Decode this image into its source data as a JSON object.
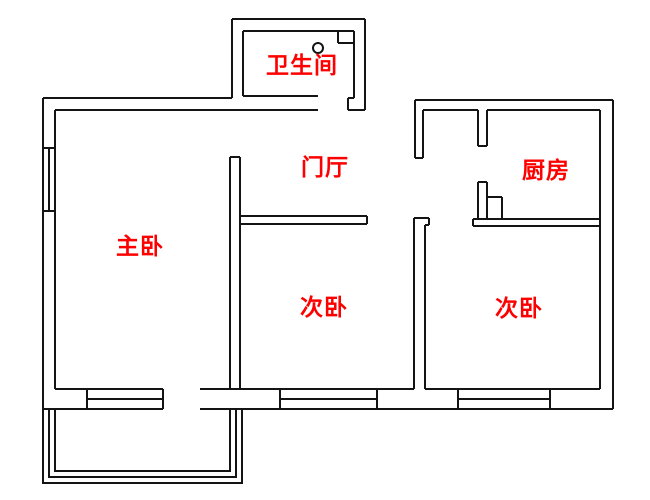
{
  "meta": {
    "type": "apartment-floor-plan",
    "background": "#ffffff"
  },
  "colors": {
    "wall": "#141414",
    "label": "#ff0000"
  },
  "canvas": {
    "width": 650,
    "height": 500
  },
  "rooms": [
    {
      "id": "bathroom",
      "label": "卫生间",
      "x": 302,
      "y": 63
    },
    {
      "id": "entrance-hall",
      "label": "门厅",
      "x": 325,
      "y": 165
    },
    {
      "id": "kitchen",
      "label": "厨房",
      "x": 546,
      "y": 168
    },
    {
      "id": "master-bedroom",
      "label": "主卧",
      "x": 140,
      "y": 244
    },
    {
      "id": "second-bedroom-middle",
      "label": "次卧",
      "x": 324,
      "y": 305
    },
    {
      "id": "second-bedroom-right",
      "label": "次卧",
      "x": 519,
      "y": 306
    }
  ],
  "plan": {
    "wall_segments": [
      [
        43,
        98,
        232,
        98
      ],
      [
        43,
        98,
        43,
        409
      ],
      [
        55,
        110,
        55,
        389
      ],
      [
        55,
        110,
        318,
        110
      ],
      [
        232,
        19,
        232,
        98
      ],
      [
        232,
        19,
        365,
        19
      ],
      [
        365,
        19,
        365,
        110
      ],
      [
        243,
        31,
        243,
        96
      ],
      [
        243,
        31,
        354,
        31
      ],
      [
        354,
        31,
        354,
        98
      ],
      [
        243,
        96,
        318,
        96
      ],
      [
        348,
        98,
        354,
        98
      ],
      [
        348,
        98,
        348,
        110
      ],
      [
        348,
        110,
        365,
        110
      ],
      [
        230,
        157,
        240,
        157
      ],
      [
        230,
        157,
        230,
        389
      ],
      [
        240,
        157,
        240,
        389
      ],
      [
        240,
        216,
        367,
        216
      ],
      [
        240,
        224,
        367,
        224
      ],
      [
        367,
        216,
        367,
        224
      ],
      [
        414,
        218,
        429,
        218
      ],
      [
        429,
        218,
        429,
        225
      ],
      [
        425,
        225,
        429,
        225
      ],
      [
        414,
        218,
        414,
        389
      ],
      [
        425,
        225,
        425,
        389
      ],
      [
        415,
        100,
        613,
        100
      ],
      [
        415,
        100,
        415,
        158
      ],
      [
        415,
        158,
        423,
        158
      ],
      [
        423,
        110,
        423,
        158
      ],
      [
        423,
        110,
        478,
        110
      ],
      [
        487,
        110,
        600,
        110
      ],
      [
        478,
        110,
        478,
        146
      ],
      [
        487,
        110,
        487,
        146
      ],
      [
        478,
        146,
        487,
        146
      ],
      [
        478,
        182,
        487,
        182
      ],
      [
        478,
        182,
        478,
        219
      ],
      [
        487,
        182,
        487,
        219
      ],
      [
        473,
        219,
        473,
        226
      ],
      [
        473,
        219,
        600,
        219
      ],
      [
        473,
        226,
        600,
        226
      ],
      [
        600,
        110,
        600,
        389
      ],
      [
        613,
        100,
        613,
        409
      ],
      [
        55,
        389,
        163,
        389
      ],
      [
        200,
        389,
        414,
        389
      ],
      [
        425,
        389,
        600,
        389
      ],
      [
        43,
        409,
        163,
        409
      ],
      [
        200,
        409,
        613,
        409
      ]
    ],
    "window_segments": [
      [
        43,
        148,
        55,
        148
      ],
      [
        43,
        211,
        55,
        211
      ],
      [
        49,
        148,
        49,
        211
      ],
      [
        87,
        389,
        87,
        409
      ],
      [
        163,
        389,
        163,
        409
      ],
      [
        87,
        399,
        163,
        399
      ],
      [
        280,
        389,
        280,
        409
      ],
      [
        377,
        389,
        377,
        409
      ],
      [
        280,
        399,
        377,
        399
      ],
      [
        458,
        389,
        458,
        409
      ],
      [
        550,
        389,
        550,
        409
      ],
      [
        458,
        399,
        550,
        399
      ]
    ],
    "balcony_railings": [
      [
        [
          43,
          409
        ],
        [
          43,
          483
        ],
        [
          242,
          483
        ],
        [
          242,
          409
        ]
      ],
      [
        [
          49,
          409
        ],
        [
          49,
          477
        ],
        [
          236,
          477
        ],
        [
          236,
          409
        ]
      ],
      [
        [
          55,
          409
        ],
        [
          55,
          471
        ],
        [
          230,
          471
        ],
        [
          230,
          409
        ]
      ]
    ],
    "fixture_segments": [
      [
        338,
        31,
        338,
        43
      ],
      [
        338,
        43,
        354,
        43
      ],
      [
        487,
        197,
        502,
        197
      ],
      [
        502,
        197,
        502,
        219
      ]
    ],
    "fixture_circle": {
      "cx": 318,
      "cy": 48,
      "r": 5
    }
  }
}
